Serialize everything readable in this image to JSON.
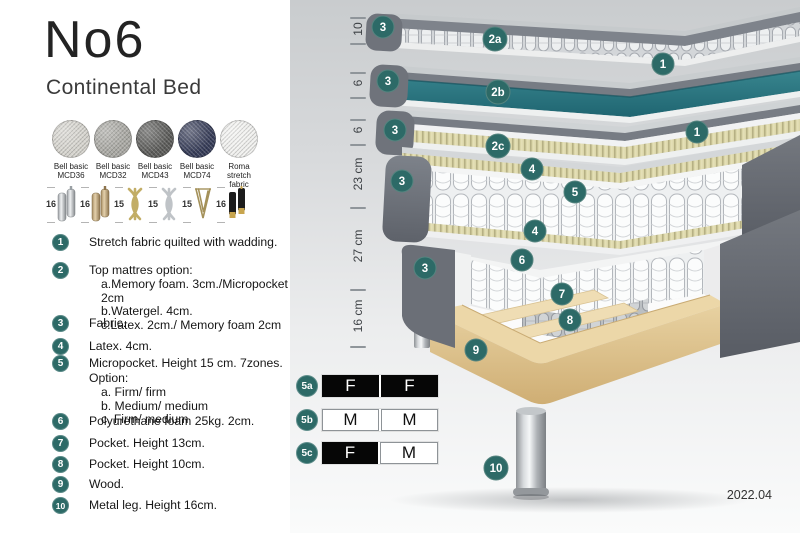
{
  "header": {
    "title": "No6",
    "subtitle": "Continental Bed"
  },
  "swatches": [
    {
      "line1": "Bell basic",
      "line2": "MCD36",
      "color": "#d6d4ce"
    },
    {
      "line1": "Bell basic",
      "line2": "MCD32",
      "color": "#aaa9a4"
    },
    {
      "line1": "Bell basic",
      "line2": "MCD43",
      "color": "#5b5b59"
    },
    {
      "line1": "Bell basic",
      "line2": "MCD74",
      "color": "#363c58"
    },
    {
      "line1": "Roma",
      "line2": "stretch fabric",
      "color": "#f1f1ef"
    }
  ],
  "legs": [
    {
      "size": "16",
      "type": "cylinder-silver"
    },
    {
      "size": "16",
      "type": "cylinder-wood"
    },
    {
      "size": "15",
      "type": "twist-gold"
    },
    {
      "size": "15",
      "type": "twist-silver"
    },
    {
      "size": "15",
      "type": "hairpin"
    },
    {
      "size": "16",
      "type": "black-gold-tip"
    }
  ],
  "list": [
    {
      "num": "1",
      "text": "Stretch fabric quilted with wadding.",
      "subs": []
    },
    {
      "num": "2",
      "text": "Top mattres option:",
      "subs": [
        "a.Memory foam. 3cm./Micropocket 2cm",
        "b.Watergel. 4cm.",
        "c.Latex. 2cm./ Memory foam 2cm"
      ]
    },
    {
      "num": "3",
      "text": "Fabric.",
      "subs": []
    },
    {
      "num": "4",
      "text": "Latex. 4cm.",
      "subs": []
    },
    {
      "num": "5",
      "text": "Micropocket. Height 15 cm. 7zones. Option:",
      "subs": [
        "a. Firm/ firm",
        "b. Medium/ medium",
        "c. Firm/ medium"
      ]
    },
    {
      "num": "6",
      "text": "Polyurethane foam 25kg. 2cm.",
      "subs": []
    },
    {
      "num": "7",
      "text": "Pocket. Height 13cm.",
      "subs": []
    },
    {
      "num": "8",
      "text": "Pocket. Height 10cm.",
      "subs": []
    },
    {
      "num": "9",
      "text": "Wood.",
      "subs": []
    },
    {
      "num": "10",
      "text": "Metal leg. Height 16cm.",
      "subs": []
    }
  ],
  "diagram": {
    "measurements": [
      "10",
      "6",
      "6",
      "23 cm",
      "27 cm",
      "16 cm"
    ],
    "callouts": [
      "3",
      "2a",
      "1",
      "3",
      "2b",
      "1",
      "3",
      "2c",
      "3",
      "4",
      "5",
      "4",
      "3",
      "6",
      "7",
      "8",
      "9",
      "10"
    ],
    "firmness": [
      {
        "id": "5a",
        "cells": [
          {
            "label": "F",
            "variant": "dark"
          },
          {
            "label": "F",
            "variant": "dark"
          }
        ]
      },
      {
        "id": "5b",
        "cells": [
          {
            "label": "M",
            "variant": "light"
          },
          {
            "label": "M",
            "variant": "light"
          }
        ]
      },
      {
        "id": "5c",
        "cells": [
          {
            "label": "F",
            "variant": "dark"
          },
          {
            "label": "M",
            "variant": "light"
          }
        ]
      }
    ],
    "version": "2022.04"
  },
  "colors": {
    "badge_teal": "#2d6a67",
    "watergel_teal": "#2e7d89",
    "fabric_gray": "#6e7279",
    "latex_khaki": "#dcd7aa",
    "wood": "#e6cf9e"
  }
}
